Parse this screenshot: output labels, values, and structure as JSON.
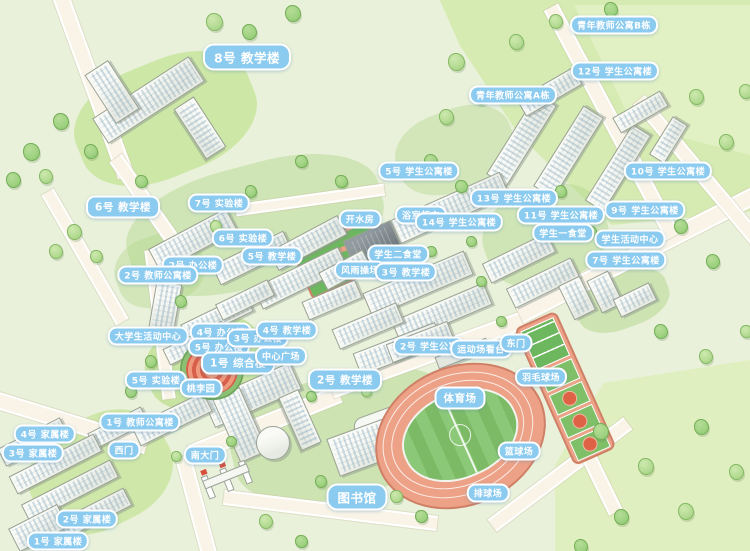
{
  "map": {
    "type": "illustrated-campus-map",
    "colors": {
      "background": "#e9f1da",
      "road": "#f9f4e7",
      "road_edge": "#ffffff",
      "forest": "#d6ebb2",
      "forest_light": "#e2f1c4",
      "tree_green": "#9ed281",
      "tree_outline": "#74ad56",
      "building_face": "#fafbf7",
      "building_shade": "#e7eae3",
      "building_outline": "#9aa296",
      "window_blue": "#6e96af",
      "track_salmon": "#eda287",
      "track_border": "#cf7f66",
      "field_green": "#8bc877",
      "court_green": "#6db85e",
      "court_red": "#dd6246",
      "label_bg": "#8ccbf0",
      "label_border": "#ffffff",
      "label_text": "#ffffff",
      "garden_red": "#d85f49"
    },
    "labels": [
      {
        "t": "8号 教学楼",
        "x": 247,
        "y": 57,
        "s": "l"
      },
      {
        "t": "青年教师公寓B栋",
        "x": 614,
        "y": 25,
        "s": "s"
      },
      {
        "t": "12号 学生公寓楼",
        "x": 615,
        "y": 71,
        "s": "s"
      },
      {
        "t": "青年教师公寓A栋",
        "x": 513,
        "y": 95,
        "s": "s"
      },
      {
        "t": "10号 学生公寓楼",
        "x": 668,
        "y": 171,
        "s": "s"
      },
      {
        "t": "5号 学生公寓楼",
        "x": 419,
        "y": 171,
        "s": "s"
      },
      {
        "t": "13号 学生公寓楼",
        "x": 514,
        "y": 198,
        "s": "s"
      },
      {
        "t": "9号 学生公寓楼",
        "x": 645,
        "y": 210,
        "s": "s"
      },
      {
        "t": "11号 学生公寓楼",
        "x": 561,
        "y": 215,
        "s": "s"
      },
      {
        "t": "学生一食堂",
        "x": 563,
        "y": 233,
        "s": "s"
      },
      {
        "t": "学生活动中心",
        "x": 630,
        "y": 239,
        "s": "s"
      },
      {
        "t": "7号 学生公寓楼",
        "x": 626,
        "y": 260,
        "s": "s"
      },
      {
        "t": "浴室超市",
        "x": 421,
        "y": 215,
        "s": "s"
      },
      {
        "t": "开水房",
        "x": 360,
        "y": 219,
        "s": "s"
      },
      {
        "t": "14号 学生公寓楼",
        "x": 459,
        "y": 222,
        "s": "s"
      },
      {
        "t": "学生二食堂",
        "x": 398,
        "y": 254,
        "s": "s"
      },
      {
        "t": "风雨操场",
        "x": 360,
        "y": 270,
        "s": "s"
      },
      {
        "t": "3号 教学楼",
        "x": 406,
        "y": 272,
        "s": "s"
      },
      {
        "t": "6号 教学楼",
        "x": 123,
        "y": 207,
        "s": "m"
      },
      {
        "t": "7号 实验楼",
        "x": 219,
        "y": 203,
        "s": "s"
      },
      {
        "t": "6号 实验楼",
        "x": 243,
        "y": 238,
        "s": "s"
      },
      {
        "t": "5号 教学楼",
        "x": 272,
        "y": 256,
        "s": "s"
      },
      {
        "t": "2号 办公楼",
        "x": 193,
        "y": 265,
        "s": "s"
      },
      {
        "t": "2号 教师公寓楼",
        "x": 158,
        "y": 275,
        "s": "s"
      },
      {
        "t": "大学生活动中心",
        "x": 148,
        "y": 336,
        "s": "s"
      },
      {
        "t": "4号 办公楼",
        "x": 221,
        "y": 332,
        "s": "s"
      },
      {
        "t": "5号 办公楼",
        "x": 219,
        "y": 347,
        "s": "s"
      },
      {
        "t": "3号 办公楼",
        "x": 258,
        "y": 338,
        "s": "s"
      },
      {
        "t": "4号 教学楼",
        "x": 287,
        "y": 330,
        "s": "s"
      },
      {
        "t": "1号 综合楼",
        "x": 238,
        "y": 363,
        "s": "m"
      },
      {
        "t": "中心广场",
        "x": 281,
        "y": 356,
        "s": "s"
      },
      {
        "t": "5号 实验楼",
        "x": 156,
        "y": 380,
        "s": "s"
      },
      {
        "t": "桃李园",
        "x": 201,
        "y": 388,
        "s": "s"
      },
      {
        "t": "2号 教学楼",
        "x": 345,
        "y": 380,
        "s": "m"
      },
      {
        "t": "1号 教师公寓楼",
        "x": 140,
        "y": 422,
        "s": "s"
      },
      {
        "t": "4号 家属楼",
        "x": 45,
        "y": 434,
        "s": "s"
      },
      {
        "t": "3号 家属楼",
        "x": 33,
        "y": 453,
        "s": "s"
      },
      {
        "t": "西门",
        "x": 124,
        "y": 450,
        "s": "s"
      },
      {
        "t": "南大门",
        "x": 205,
        "y": 455,
        "s": "s"
      },
      {
        "t": "2号 家属楼",
        "x": 87,
        "y": 519,
        "s": "s"
      },
      {
        "t": "1号 家属楼",
        "x": 58,
        "y": 541,
        "s": "s"
      },
      {
        "t": "图书馆",
        "x": 357,
        "y": 497,
        "s": "l"
      },
      {
        "t": "2号 学生公寓",
        "x": 429,
        "y": 346,
        "s": "s"
      },
      {
        "t": "运动场看台",
        "x": 481,
        "y": 349,
        "s": "s"
      },
      {
        "t": "东门",
        "x": 516,
        "y": 343,
        "s": "s"
      },
      {
        "t": "体育场",
        "x": 460,
        "y": 398,
        "s": "m"
      },
      {
        "t": "羽毛球场",
        "x": 541,
        "y": 377,
        "s": "s"
      },
      {
        "t": "篮球场",
        "x": 519,
        "y": 451,
        "s": "s"
      },
      {
        "t": "排球场",
        "x": 488,
        "y": 493,
        "s": "s"
      }
    ],
    "roads": [
      [
        92,
        80,
        200,
        13,
        70
      ],
      [
        150,
        205,
        120,
        11,
        55
      ],
      [
        85,
        255,
        150,
        10,
        60
      ],
      [
        160,
        322,
        150,
        9,
        83
      ],
      [
        70,
        420,
        160,
        13,
        17
      ],
      [
        265,
        422,
        160,
        14,
        -22
      ],
      [
        430,
        352,
        210,
        14,
        -20
      ],
      [
        640,
        252,
        270,
        14,
        -27
      ],
      [
        196,
        505,
        105,
        12,
        75
      ],
      [
        330,
        508,
        215,
        11,
        7
      ],
      [
        560,
        472,
        170,
        11,
        -37
      ],
      [
        572,
        420,
        200,
        11,
        64
      ],
      [
        612,
        120,
        260,
        12,
        62
      ],
      [
        700,
        170,
        190,
        11,
        50
      ],
      [
        310,
        198,
        150,
        8,
        -8
      ]
    ],
    "forests": [
      {
        "x": 420,
        "y": 0,
        "w": 330,
        "h": 225,
        "c": "#d6ebb2",
        "clip": "polygon(6% 0,100% 0,100% 94%,58% 100%,30% 60%,12% 20%)"
      },
      {
        "x": 555,
        "y": 5,
        "w": 195,
        "h": 150,
        "c": "#e2f1c4",
        "clip": "polygon(10% 0,100% 0,100% 100%,40% 80%)"
      },
      {
        "x": 555,
        "y": 360,
        "w": 195,
        "h": 191,
        "c": "#e0efc0",
        "clip": "polygon(25% 12%,100% 0,100% 100%,0 100%,0 55%)"
      }
    ],
    "patches": [
      [
        165,
        118,
        185,
        115,
        -22,
        "#cde7a6"
      ],
      [
        255,
        225,
        260,
        120,
        -15,
        "rgba(178,214,138,0.45)"
      ],
      [
        205,
        362,
        120,
        85,
        -20,
        "#c9e4a2"
      ],
      [
        345,
        435,
        230,
        120,
        -14,
        "rgba(178,214,138,0.5)"
      ],
      [
        545,
        235,
        125,
        95,
        -20,
        "rgba(178,214,138,0.45)"
      ],
      [
        622,
        300,
        95,
        55,
        -20,
        "rgba(178,214,138,0.5)"
      ],
      [
        100,
        472,
        145,
        110,
        -27,
        "#cfe7a8"
      ],
      [
        455,
        150,
        120,
        80,
        -20,
        "rgba(178,214,138,0.4)"
      ],
      [
        160,
        270,
        90,
        70,
        -20,
        "rgba(178,214,138,0.4)"
      ]
    ],
    "buildings": [
      [
        148,
        100,
        115,
        30,
        -33,
        "s"
      ],
      [
        200,
        128,
        60,
        24,
        57,
        "s"
      ],
      [
        112,
        92,
        28,
        58,
        -33,
        "t"
      ],
      [
        521,
        140,
        95,
        24,
        -58,
        "s"
      ],
      [
        568,
        152,
        95,
        24,
        -58,
        "s"
      ],
      [
        618,
        168,
        90,
        22,
        -58,
        "s"
      ],
      [
        549,
        92,
        65,
        20,
        -30,
        "s"
      ],
      [
        640,
        112,
        55,
        18,
        -30,
        "s"
      ],
      [
        668,
        140,
        45,
        18,
        -58,
        "s"
      ],
      [
        450,
        208,
        120,
        26,
        -24,
        "s"
      ],
      [
        374,
        248,
        52,
        38,
        -24,
        "d"
      ],
      [
        300,
        278,
        95,
        24,
        -26,
        "s"
      ],
      [
        252,
        258,
        80,
        22,
        -26,
        "s"
      ],
      [
        418,
        284,
        110,
        26,
        -23,
        "s"
      ],
      [
        442,
        313,
        100,
        24,
        -23,
        "s"
      ],
      [
        368,
        326,
        70,
        22,
        -23,
        "s"
      ],
      [
        332,
        300,
        58,
        20,
        -23,
        "s"
      ],
      [
        519,
        258,
        72,
        22,
        -26,
        "s"
      ],
      [
        543,
        283,
        72,
        22,
        -26,
        "s"
      ],
      [
        577,
        298,
        24,
        38,
        -26,
        "t"
      ],
      [
        605,
        292,
        24,
        36,
        -26,
        "t"
      ],
      [
        635,
        300,
        40,
        20,
        -26,
        "s"
      ],
      [
        193,
        240,
        88,
        26,
        -28,
        "s"
      ],
      [
        308,
        243,
        78,
        22,
        -28,
        "s"
      ],
      [
        345,
        270,
        50,
        20,
        -28,
        "s"
      ],
      [
        165,
        308,
        26,
        52,
        10,
        "t"
      ],
      [
        217,
        318,
        72,
        20,
        -26,
        "s"
      ],
      [
        196,
        343,
        66,
        18,
        -26,
        "s"
      ],
      [
        245,
        300,
        58,
        18,
        -26,
        "s"
      ],
      [
        252,
        395,
        95,
        30,
        -24,
        "s"
      ],
      [
        240,
        425,
        30,
        70,
        -24,
        "s"
      ],
      [
        300,
        420,
        58,
        22,
        66,
        "s"
      ],
      [
        398,
        349,
        88,
        24,
        -21,
        "s"
      ],
      [
        420,
        420,
        130,
        46,
        -20,
        "lib"
      ],
      [
        366,
        446,
        70,
        40,
        -20,
        "s"
      ],
      [
        172,
        419,
        80,
        22,
        -26,
        "s"
      ],
      [
        118,
        428,
        60,
        18,
        -27,
        "s"
      ],
      [
        33,
        442,
        70,
        20,
        -27,
        "s"
      ],
      [
        55,
        464,
        95,
        20,
        -27,
        "s"
      ],
      [
        70,
        491,
        100,
        20,
        -27,
        "s"
      ],
      [
        85,
        518,
        95,
        20,
        -27,
        "s"
      ],
      [
        38,
        528,
        55,
        26,
        -27,
        "s"
      ],
      [
        420,
        342,
        66,
        20,
        -21,
        "s"
      ],
      [
        462,
        353,
        55,
        13,
        -21,
        "p"
      ]
    ],
    "annex_circle": {
      "x": 273,
      "y": 443,
      "r": 17
    },
    "basket_courts_nw": {
      "x": 337,
      "y": 256,
      "w": 78,
      "h": 50,
      "a": -24
    },
    "trees": [
      [
        213,
        20,
        15
      ],
      [
        248,
        30,
        13
      ],
      [
        292,
        12,
        14
      ],
      [
        60,
        120,
        14
      ],
      [
        30,
        150,
        15
      ],
      [
        12,
        178,
        13
      ],
      [
        45,
        175,
        12
      ],
      [
        90,
        150,
        12
      ],
      [
        73,
        230,
        13
      ],
      [
        55,
        250,
        12
      ],
      [
        95,
        255,
        11
      ],
      [
        140,
        180,
        11
      ],
      [
        250,
        190,
        10
      ],
      [
        215,
        225,
        10
      ],
      [
        180,
        300,
        10
      ],
      [
        150,
        360,
        10
      ],
      [
        130,
        390,
        10
      ],
      [
        340,
        180,
        11
      ],
      [
        300,
        160,
        11
      ],
      [
        430,
        250,
        9
      ],
      [
        470,
        240,
        9
      ],
      [
        480,
        280,
        9
      ],
      [
        500,
        320,
        9
      ],
      [
        455,
        60,
        15
      ],
      [
        480,
        95,
        14
      ],
      [
        445,
        115,
        13
      ],
      [
        515,
        40,
        13
      ],
      [
        555,
        20,
        12
      ],
      [
        610,
        8,
        12
      ],
      [
        430,
        160,
        12
      ],
      [
        460,
        185,
        11
      ],
      [
        695,
        95,
        13
      ],
      [
        725,
        140,
        13
      ],
      [
        745,
        90,
        12
      ],
      [
        680,
        225,
        12
      ],
      [
        712,
        260,
        12
      ],
      [
        660,
        330,
        12
      ],
      [
        705,
        355,
        12
      ],
      [
        745,
        330,
        11
      ],
      [
        600,
        430,
        14
      ],
      [
        645,
        465,
        14
      ],
      [
        700,
        425,
        13
      ],
      [
        620,
        515,
        13
      ],
      [
        685,
        510,
        14
      ],
      [
        735,
        470,
        13
      ],
      [
        580,
        545,
        12
      ],
      [
        265,
        520,
        12
      ],
      [
        300,
        540,
        11
      ],
      [
        320,
        480,
        10
      ],
      [
        395,
        495,
        11
      ],
      [
        420,
        515,
        11
      ],
      [
        230,
        440,
        9
      ],
      [
        175,
        455,
        9
      ],
      [
        525,
        210,
        10
      ],
      [
        560,
        190,
        10
      ],
      [
        590,
        230,
        9
      ],
      [
        640,
        260,
        9
      ],
      [
        365,
        390,
        9
      ],
      [
        310,
        395,
        9
      ]
    ]
  }
}
